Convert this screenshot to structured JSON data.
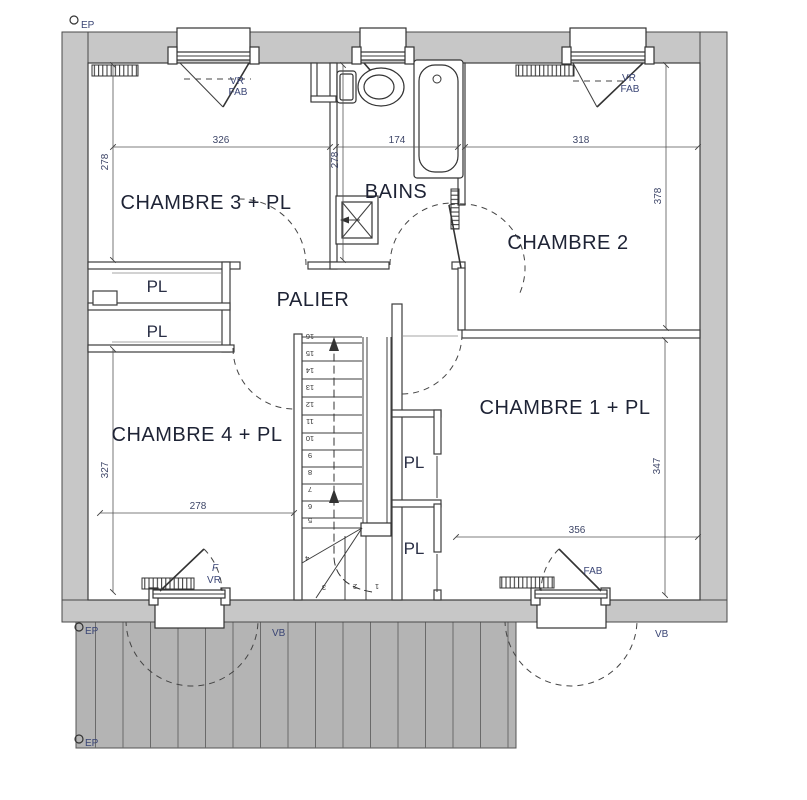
{
  "title": "floor-plan-upper-storey",
  "rooms": {
    "chambre3": "CHAMBRE 3 + PL",
    "bains": "BAINS",
    "chambre2": "CHAMBRE 2",
    "palier": "PALIER",
    "chambre4": "CHAMBRE 4 + PL",
    "chambre1": "CHAMBRE 1 + PL",
    "closet": "PL"
  },
  "dimensions_cm": {
    "chambre3_width": "326",
    "bains_width": "174",
    "chambre2_width": "318",
    "chambre3_depth": "278",
    "bains_depth": "278",
    "chambre2_depth": "378",
    "chambre4_depth": "327",
    "chambre4_width": "278",
    "chambre1_depth": "347",
    "chambre1_width": "356"
  },
  "annotations": {
    "vr": "VR",
    "fab": "FAB",
    "f": "F",
    "vb": "VB",
    "ep": "EP"
  },
  "stairs": {
    "numbers": [
      "16",
      "15",
      "14",
      "13",
      "12",
      "11",
      "10",
      "9",
      "8",
      "7",
      "6",
      "5",
      "4",
      "3",
      "2",
      "1"
    ]
  },
  "colors": {
    "wall_fill": "#c7c7c7",
    "deck_fill": "#b4b4b4",
    "line": "#3d3d3d",
    "room_text": "#1e2335",
    "dim_text": "#3e4668",
    "annotation_text": "#3a4575"
  }
}
